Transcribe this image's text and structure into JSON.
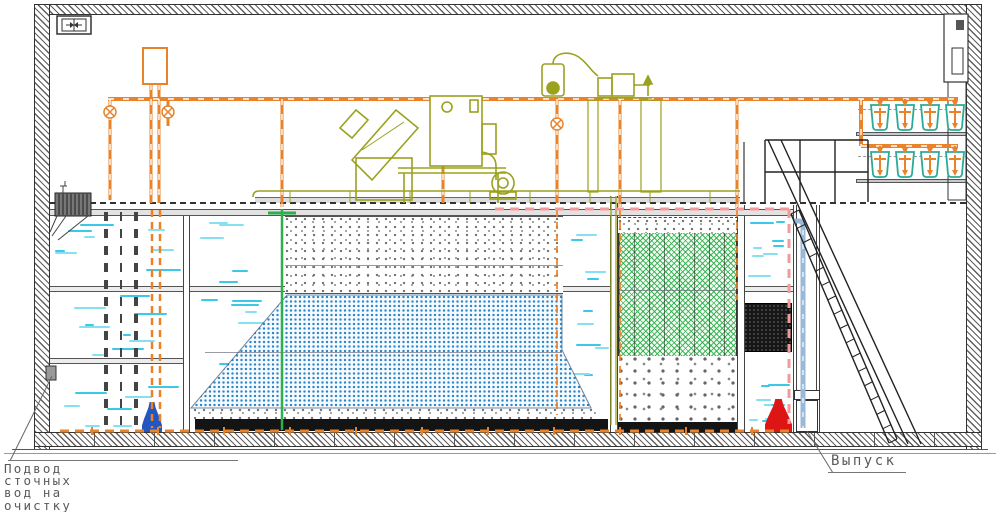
{
  "drawing": {
    "labels": {
      "inlet_line1": "Подвод",
      "inlet_line2": "сточных",
      "inlet_line3": "вод на",
      "inlet_line4": "очистку",
      "outlet": "Выпуск"
    },
    "equipment": {
      "blower_rows": [
        {
          "count": 4
        },
        {
          "count": 4
        }
      ]
    },
    "colors": {
      "pipe_orange": "#e8832b",
      "pipe_orange_dark": "#b05a10",
      "machine_olive": "#9aa21e",
      "water_cyan": "#3cc8e8",
      "water_cyan_light": "#85e0f2",
      "media_blue": "#2f86c4",
      "media_green": "#2fae4c",
      "pipe_pink": "#f59a9a",
      "pipe_steelblue": "#9ab8d8",
      "pump_red": "#dd1515",
      "pump_blue": "#2256c0",
      "blower_teal": "#2aab97"
    }
  }
}
